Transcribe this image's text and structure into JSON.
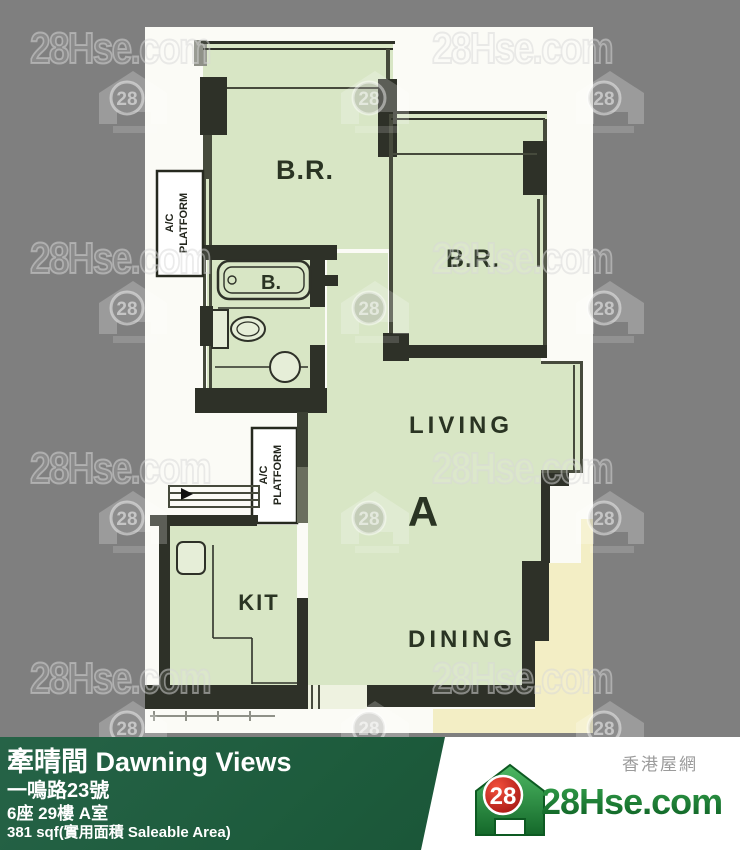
{
  "watermark": {
    "text": "28Hse.com",
    "badge": "28"
  },
  "plan": {
    "labels": {
      "bedroom": "B.R.",
      "living": "LIVING",
      "dining": "DINING",
      "kitchen": "KIT",
      "unit_letter": "A",
      "bath": "B.",
      "ac_line1": "A/C",
      "ac_line2": "PLATFORM"
    }
  },
  "info_bar": {
    "building_name": "牽晴間 Dawning Views",
    "address": "一鳴路23號",
    "unit": "6座 29樓 A室",
    "area": "381 sqf(實用面積 Saleable Area)"
  },
  "brand": {
    "site_zh": "香港屋網",
    "site_en": "28Hse.com",
    "badge": "28"
  },
  "theme": {
    "gray-bg": "#7f7f7f",
    "paper": "#fbfbf6",
    "room-fill": "#d8e6c5",
    "adjacent-fill": "#f3eec5",
    "wall": "#2e3128",
    "bar-green": "#1d5b3c",
    "brand-green": "#157a30",
    "badge-red": "#c41818"
  }
}
